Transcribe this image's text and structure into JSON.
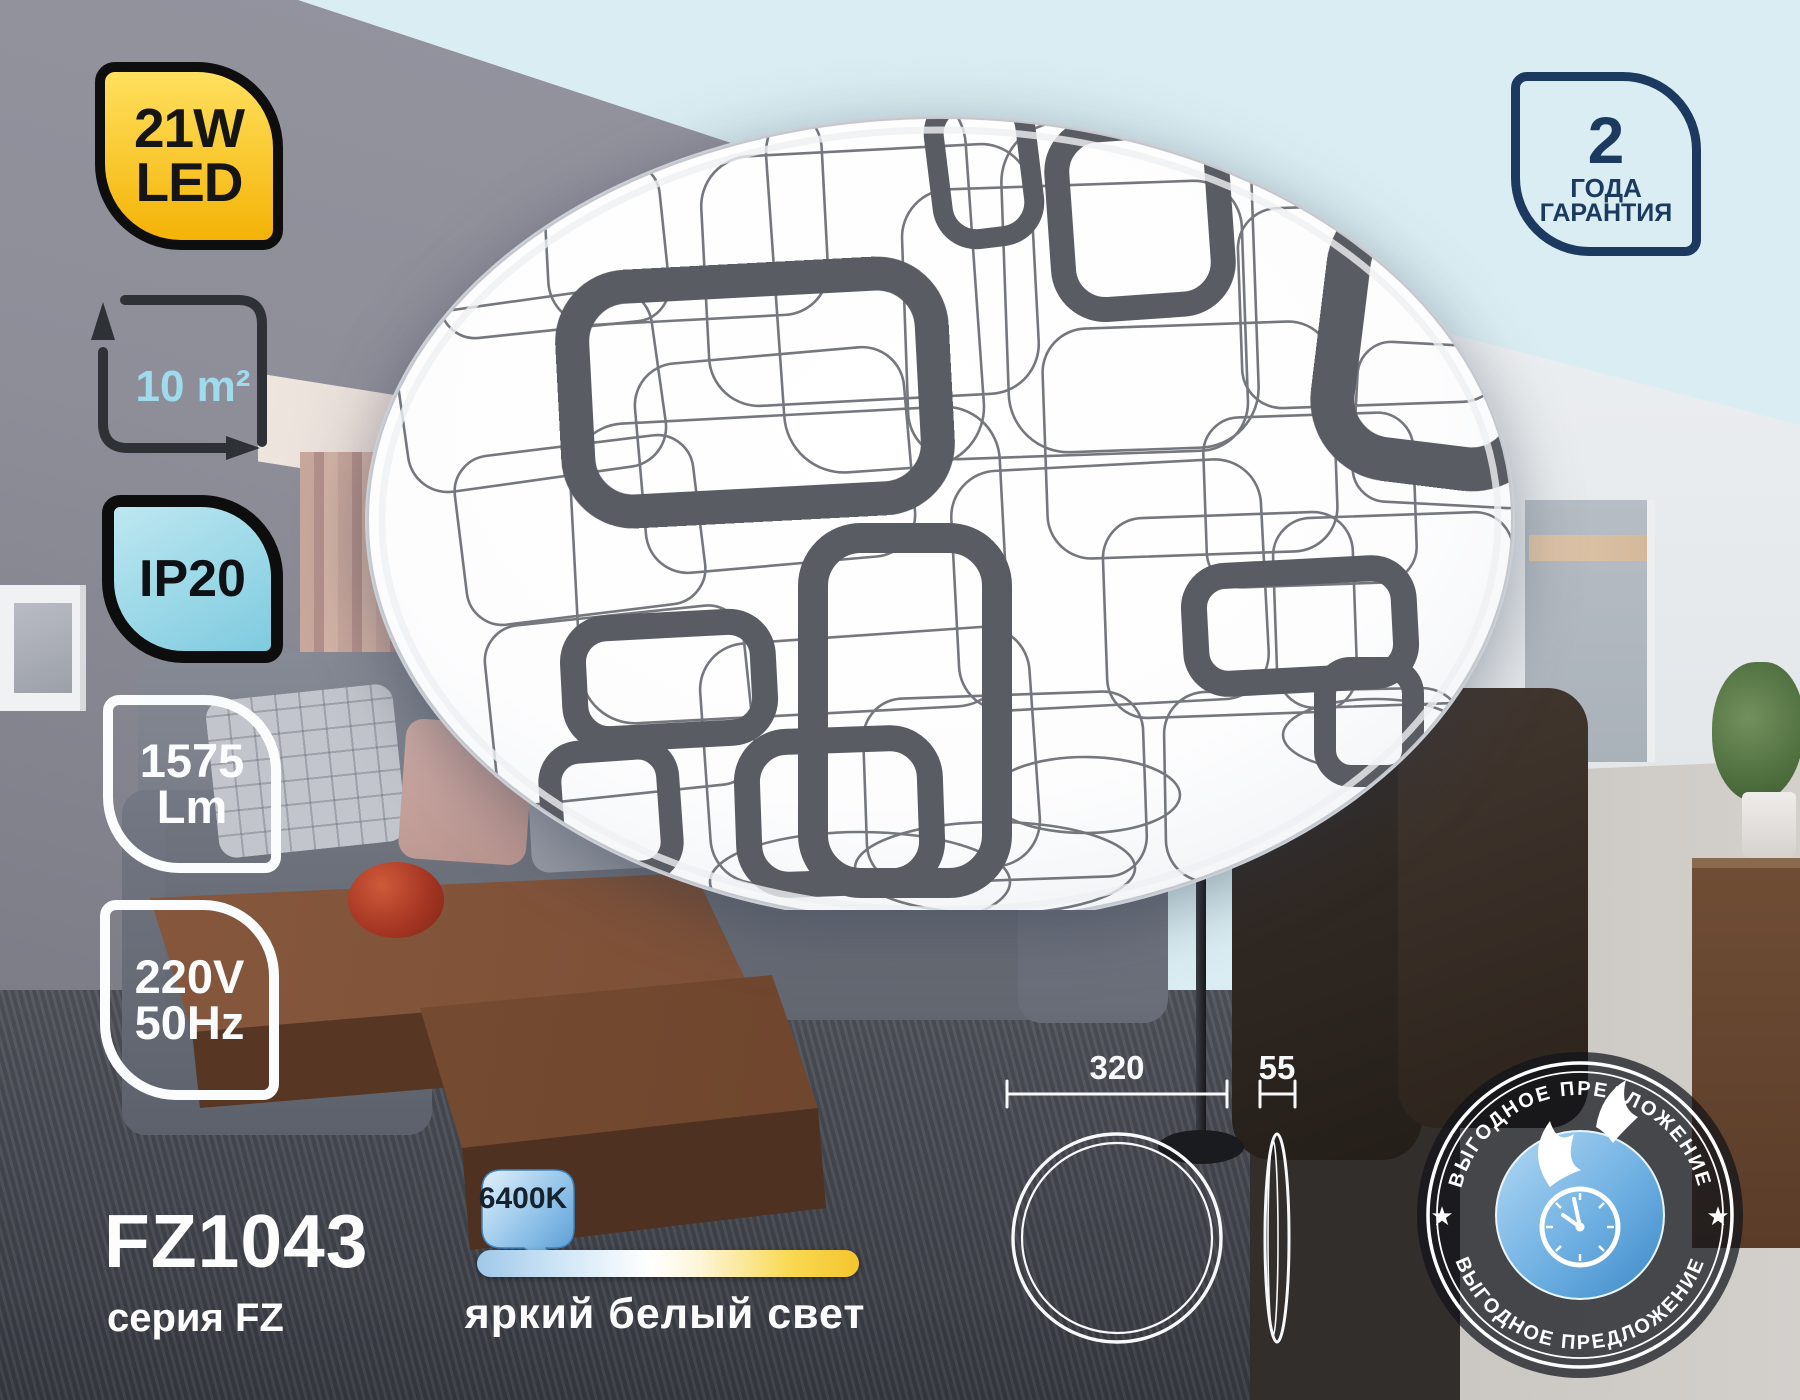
{
  "product": {
    "model": "FZ1043",
    "series": "серия FZ"
  },
  "badges": {
    "power": {
      "line1": "21W",
      "line2": "LED"
    },
    "area": {
      "value": "10 m²"
    },
    "ip": {
      "value": "IP20"
    },
    "lumens": {
      "line1": "1575",
      "line2": "Lm"
    },
    "voltage": {
      "line1": "220V",
      "line2": "50Hz"
    },
    "warranty": {
      "number": "2",
      "line1": "ГОДА",
      "line2": "ГАРАНТИЯ"
    }
  },
  "light": {
    "temperature": "6400K",
    "description": "яркий белый свет"
  },
  "dimensions": {
    "diameter": "320",
    "height": "55"
  },
  "promo": {
    "text_top": "ВЫГОДНОЕ ПРЕДЛОЖЕНИЕ",
    "text_bottom": "ВЫГОДНОЕ ПРЕДЛОЖЕНИЕ",
    "star_left": "★",
    "star_right": "★"
  },
  "colors": {
    "accent_yellow": "#f4b307",
    "accent_cyan": "#8fd4e6",
    "navy": "#1c3a60",
    "promo_blue": "#4d94cf",
    "background_pale_blue": "#d9edf2"
  }
}
